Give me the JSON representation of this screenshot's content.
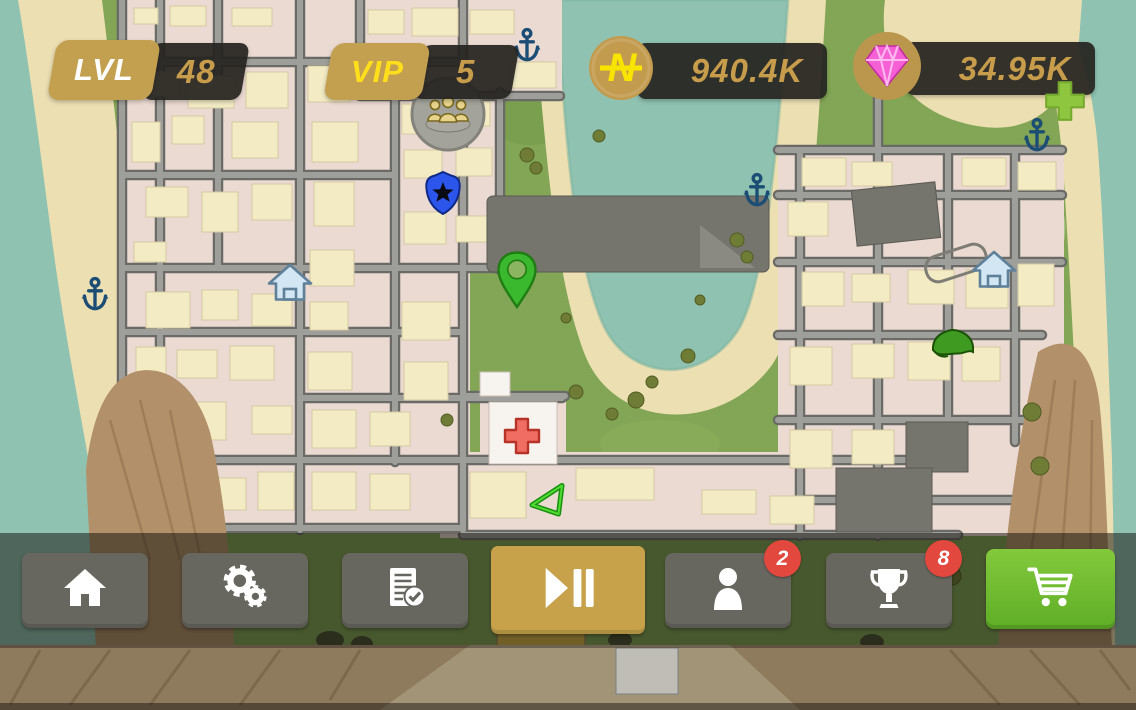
{
  "hud": {
    "level": {
      "label": "LVL",
      "value": "48"
    },
    "vip": {
      "label": "VIP",
      "value": "5"
    },
    "cash": {
      "amount": "940.4K",
      "currency_symbol": "N",
      "icon": "cash-coin-icon"
    },
    "gems": {
      "amount": "34.95K",
      "icon": "diamond-icon"
    },
    "add_gems_icon": "plus-icon"
  },
  "toolbar": {
    "buttons": [
      {
        "id": "home",
        "icon": "home-icon",
        "style": "gray",
        "badge": null
      },
      {
        "id": "settings",
        "icon": "gears-icon",
        "style": "gray",
        "badge": null
      },
      {
        "id": "tasks",
        "icon": "document-check-icon",
        "style": "gray",
        "badge": null
      },
      {
        "id": "play-pause",
        "icon": "play-pause-icon",
        "style": "gold",
        "badge": null
      },
      {
        "id": "friends",
        "icon": "person-icon",
        "style": "gray",
        "badge": "2"
      },
      {
        "id": "achievements",
        "icon": "trophy-icon",
        "style": "gray",
        "badge": "8"
      },
      {
        "id": "shop",
        "icon": "cart-icon",
        "style": "green",
        "badge": null
      }
    ]
  },
  "map": {
    "markers": [
      {
        "type": "anchor",
        "x": 95,
        "y": 295
      },
      {
        "type": "anchor",
        "x": 527,
        "y": 46
      },
      {
        "type": "anchor",
        "x": 757,
        "y": 191
      },
      {
        "type": "anchor",
        "x": 1037,
        "y": 136
      },
      {
        "type": "monument",
        "x": 448,
        "y": 112
      },
      {
        "type": "police-badge",
        "x": 443,
        "y": 193
      },
      {
        "type": "location-pin",
        "x": 517,
        "y": 310
      },
      {
        "type": "safehouse",
        "x": 290,
        "y": 282
      },
      {
        "type": "safehouse",
        "x": 994,
        "y": 269
      },
      {
        "type": "hospital-cross",
        "x": 522,
        "y": 436
      },
      {
        "type": "player-arrow",
        "x": 548,
        "y": 500
      },
      {
        "type": "helmet",
        "x": 953,
        "y": 344
      }
    ]
  },
  "colors": {
    "gold": "#c2a04f",
    "value_gold": "#c79d4c",
    "vip_yellow": "#ffdf1b",
    "coin_yellow": "#f9e400",
    "gem_pink": "#f561d4",
    "plus_green": "#8ec63f",
    "btn_gray": "#67665f",
    "btn_gold": "#c7a24b",
    "cart_green_top": "#83c93c",
    "cart_green_bottom": "#5fae27",
    "badge_red": "#e2483d",
    "ocean": "#8fc2b1",
    "sand": "#ecdfb2",
    "grass": "#82a655",
    "city": "#ebdad2",
    "road": "#9b9b97",
    "building": "#f3ebc4",
    "mountain": "#b2906a"
  }
}
